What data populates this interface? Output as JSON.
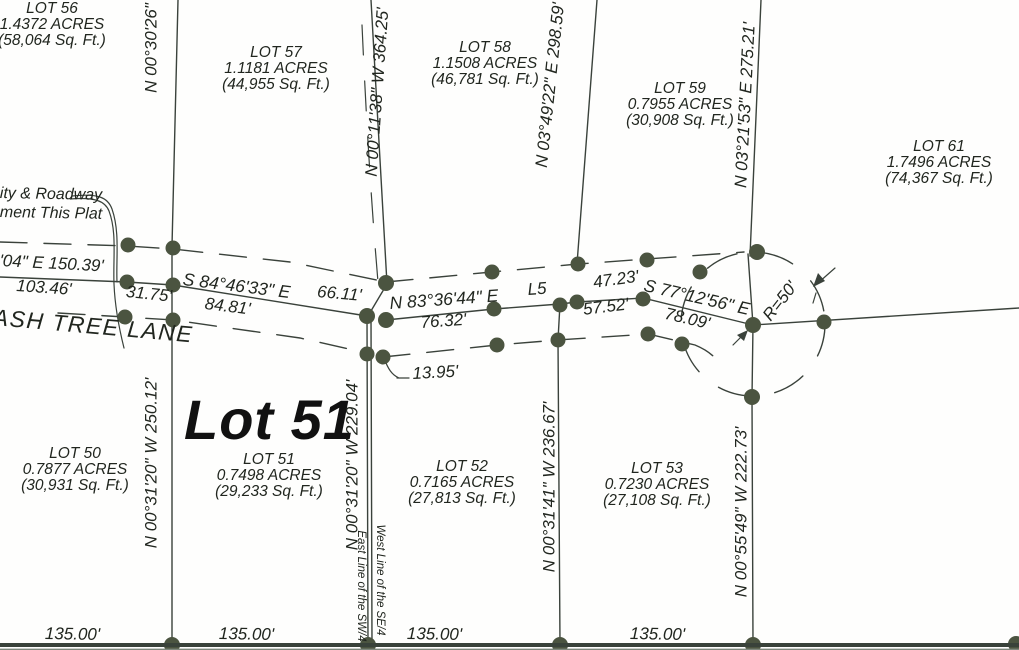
{
  "drawing": {
    "road_name": "ASH TREE LANE",
    "featured_lot": "Lot 51",
    "note": {
      "line1": "ity & Roadway",
      "line2": "ment This Plat"
    },
    "lots": {
      "lot56": {
        "name": "LOT 56",
        "acres": "1.4372 ACRES",
        "sqft": "(58,064 Sq. Ft.)"
      },
      "lot57": {
        "name": "LOT 57",
        "acres": "1.1181 ACRES",
        "sqft": "(44,955 Sq. Ft.)"
      },
      "lot58": {
        "name": "LOT 58",
        "acres": "1.1508 ACRES",
        "sqft": "(46,781 Sq. Ft.)"
      },
      "lot59": {
        "name": "LOT 59",
        "acres": "0.7955 ACRES",
        "sqft": "(30,908 Sq. Ft.)"
      },
      "lot61": {
        "name": "LOT 61",
        "acres": "1.7496 ACRES",
        "sqft": "(74,367 Sq. Ft.)"
      },
      "lot50": {
        "name": "LOT 50",
        "acres": "0.7877 ACRES",
        "sqft": "(30,931 Sq. Ft.)"
      },
      "lot51": {
        "name": "LOT 51",
        "acres": "0.7498 ACRES",
        "sqft": "(29,233 Sq. Ft.)"
      },
      "lot52": {
        "name": "LOT 52",
        "acres": "0.7165 ACRES",
        "sqft": "(27,813 Sq. Ft.)"
      },
      "lot53": {
        "name": "LOT 53",
        "acres": "0.7230 ACRES",
        "sqft": "(27,108 Sq. Ft.)"
      }
    },
    "boundary_bearings": {
      "west_line_top": "N 00°30'26\"",
      "lot50_51": "N 00°31'20\" W 250.12'",
      "quarter_top": "N 00°11'38\" W 364.25'",
      "quarter_bottom": "N 00°31'20\" W 229.04'",
      "lot58_59": "N 03°49'22\" E 298.59'",
      "lot52_53": "N 00°31'41\" W 236.67'",
      "lot59_61": "N 03°21'53\" E 275.21'",
      "lot53_east": "N 00°55'49\" W 222.73'"
    },
    "section_lines": {
      "west_se": "West Line of the SE/4",
      "east_sw": "East Line of the SW/4"
    },
    "road_dims": {
      "left_partial_bearing": "'04\" E 150.39'",
      "left_dist": "103.46'",
      "left_tick": "31.75'",
      "seg1_bearing": "S 84°46'33\" E",
      "seg1_dist": "84.81'",
      "mid_tick": "66.11'",
      "seg2_bearing": "N 83°36'44\" E",
      "seg2_dist": "76.32'",
      "seg3_label": "L5",
      "seg3_dist_top": "47.23'",
      "seg3_dist_bottom": "57.52'",
      "seg4_bearing": "S 77°12'56\" E",
      "seg4_dist": "78.09'",
      "tie_dist": "13.95'",
      "radius": "R=50'"
    },
    "south_distances": [
      "135.00'",
      "135.00'",
      "135.00'",
      "135.00'"
    ],
    "colors": {
      "ink": "#3a423b",
      "dot": "#4b5440",
      "text": "#21261f"
    }
  }
}
